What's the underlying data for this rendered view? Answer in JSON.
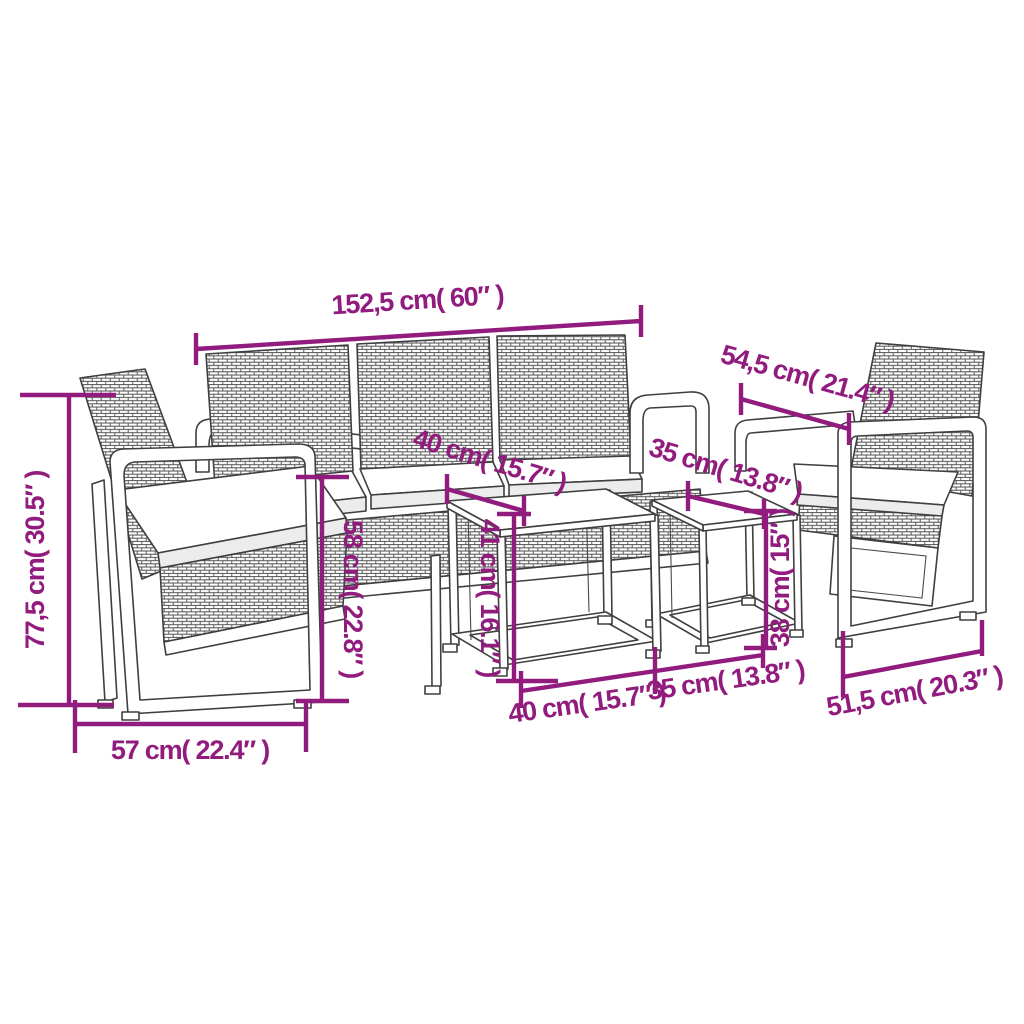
{
  "figure": {
    "type": "product-dimensions-line-drawing",
    "subject": "5-piece garden lounge set: 3-seater rattan sofa, two armchairs, two nesting side tables with cushions",
    "background": "#ffffff",
    "colors": {
      "dimension_accent": "#911C7E",
      "line_art": "#3F3F3F",
      "cushion_shade": "#ECECEC"
    }
  },
  "dimensions": {
    "sofa_width": {
      "label": "152,5 cm( 60″ )"
    },
    "armchair_depth": {
      "label": "54,5 cm( 21.4″ )"
    },
    "overall_height": {
      "label": "77,5 cm( 30.5″ )"
    },
    "armchair_width": {
      "label": "57 cm( 22.4″ )"
    },
    "seat_depth": {
      "label": "58 cm( 22.8″ )"
    },
    "table_large_top": {
      "label": "40 cm( 15.7″ )"
    },
    "table_small_top": {
      "label": "35 cm( 13.8″ )"
    },
    "table_large_height": {
      "label": "41 cm( 16.1″ )"
    },
    "table_small_height": {
      "label": "38 cm( 15″ )"
    },
    "table_large_width": {
      "label": "40 cm( 15.7″ )"
    },
    "table_small_width": {
      "label": "35 cm( 13.8″ )"
    },
    "armchair_right_width": {
      "label": "51,5 cm( 20.3″ )"
    }
  }
}
